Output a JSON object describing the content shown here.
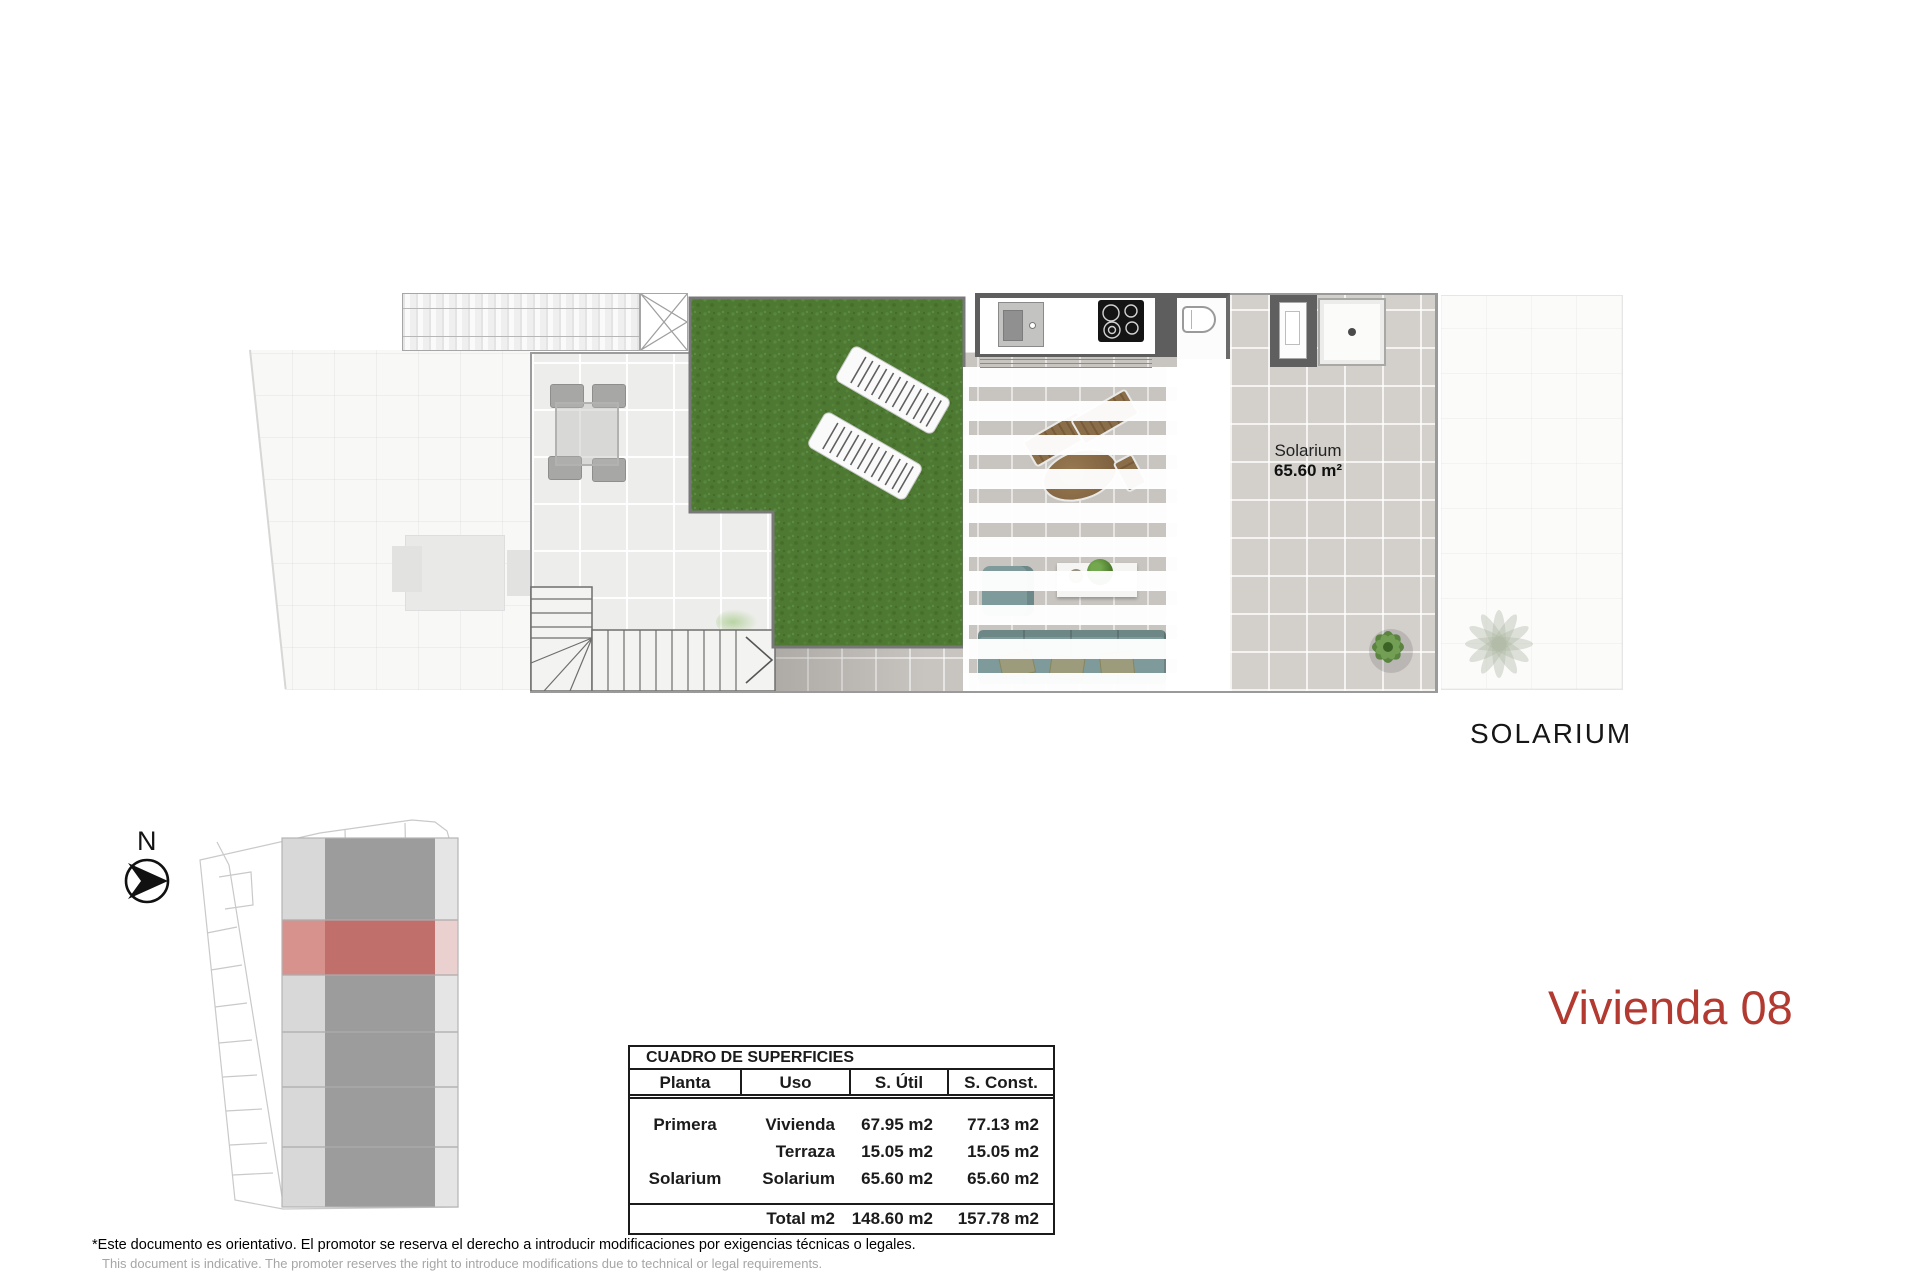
{
  "unit_title": "Vivienda 08",
  "floor_plan": {
    "caption": "SOLARIUM",
    "room_label": {
      "name": "Solarium",
      "area": "65.60 m²"
    }
  },
  "compass": {
    "north_label": "N"
  },
  "surfaces_table": {
    "title": "CUADRO DE SUPERFICIES",
    "columns": {
      "planta": "Planta",
      "uso": "Uso",
      "util": "S. Útil",
      "const": "S. Const."
    },
    "rows": [
      {
        "planta": "Primera",
        "uso": "Vivienda",
        "util": "67.95 m2",
        "const": "77.13 m2"
      },
      {
        "planta": "",
        "uso": "Terraza",
        "util": "15.05 m2",
        "const": "15.05 m2"
      },
      {
        "planta": "Solarium",
        "uso": "Solarium",
        "util": "65.60 m2",
        "const": "65.60 m2"
      }
    ],
    "total_row": {
      "label": "Total m2",
      "util": "148.60 m2",
      "const": "157.78 m2"
    }
  },
  "footer": {
    "disclaimer_es": "*Este documento es orientativo. El promotor se reserva el derecho a introducir modificaciones por exigencias técnicas o legales.",
    "disclaimer_en": "This document is indicative. The promoter reserves the right to introduce modifications due to technical or legal requirements."
  },
  "colors": {
    "accent_red": "#b23a30",
    "site_highlight_red": "#c06f6a",
    "grass_green": "#4e7932"
  }
}
